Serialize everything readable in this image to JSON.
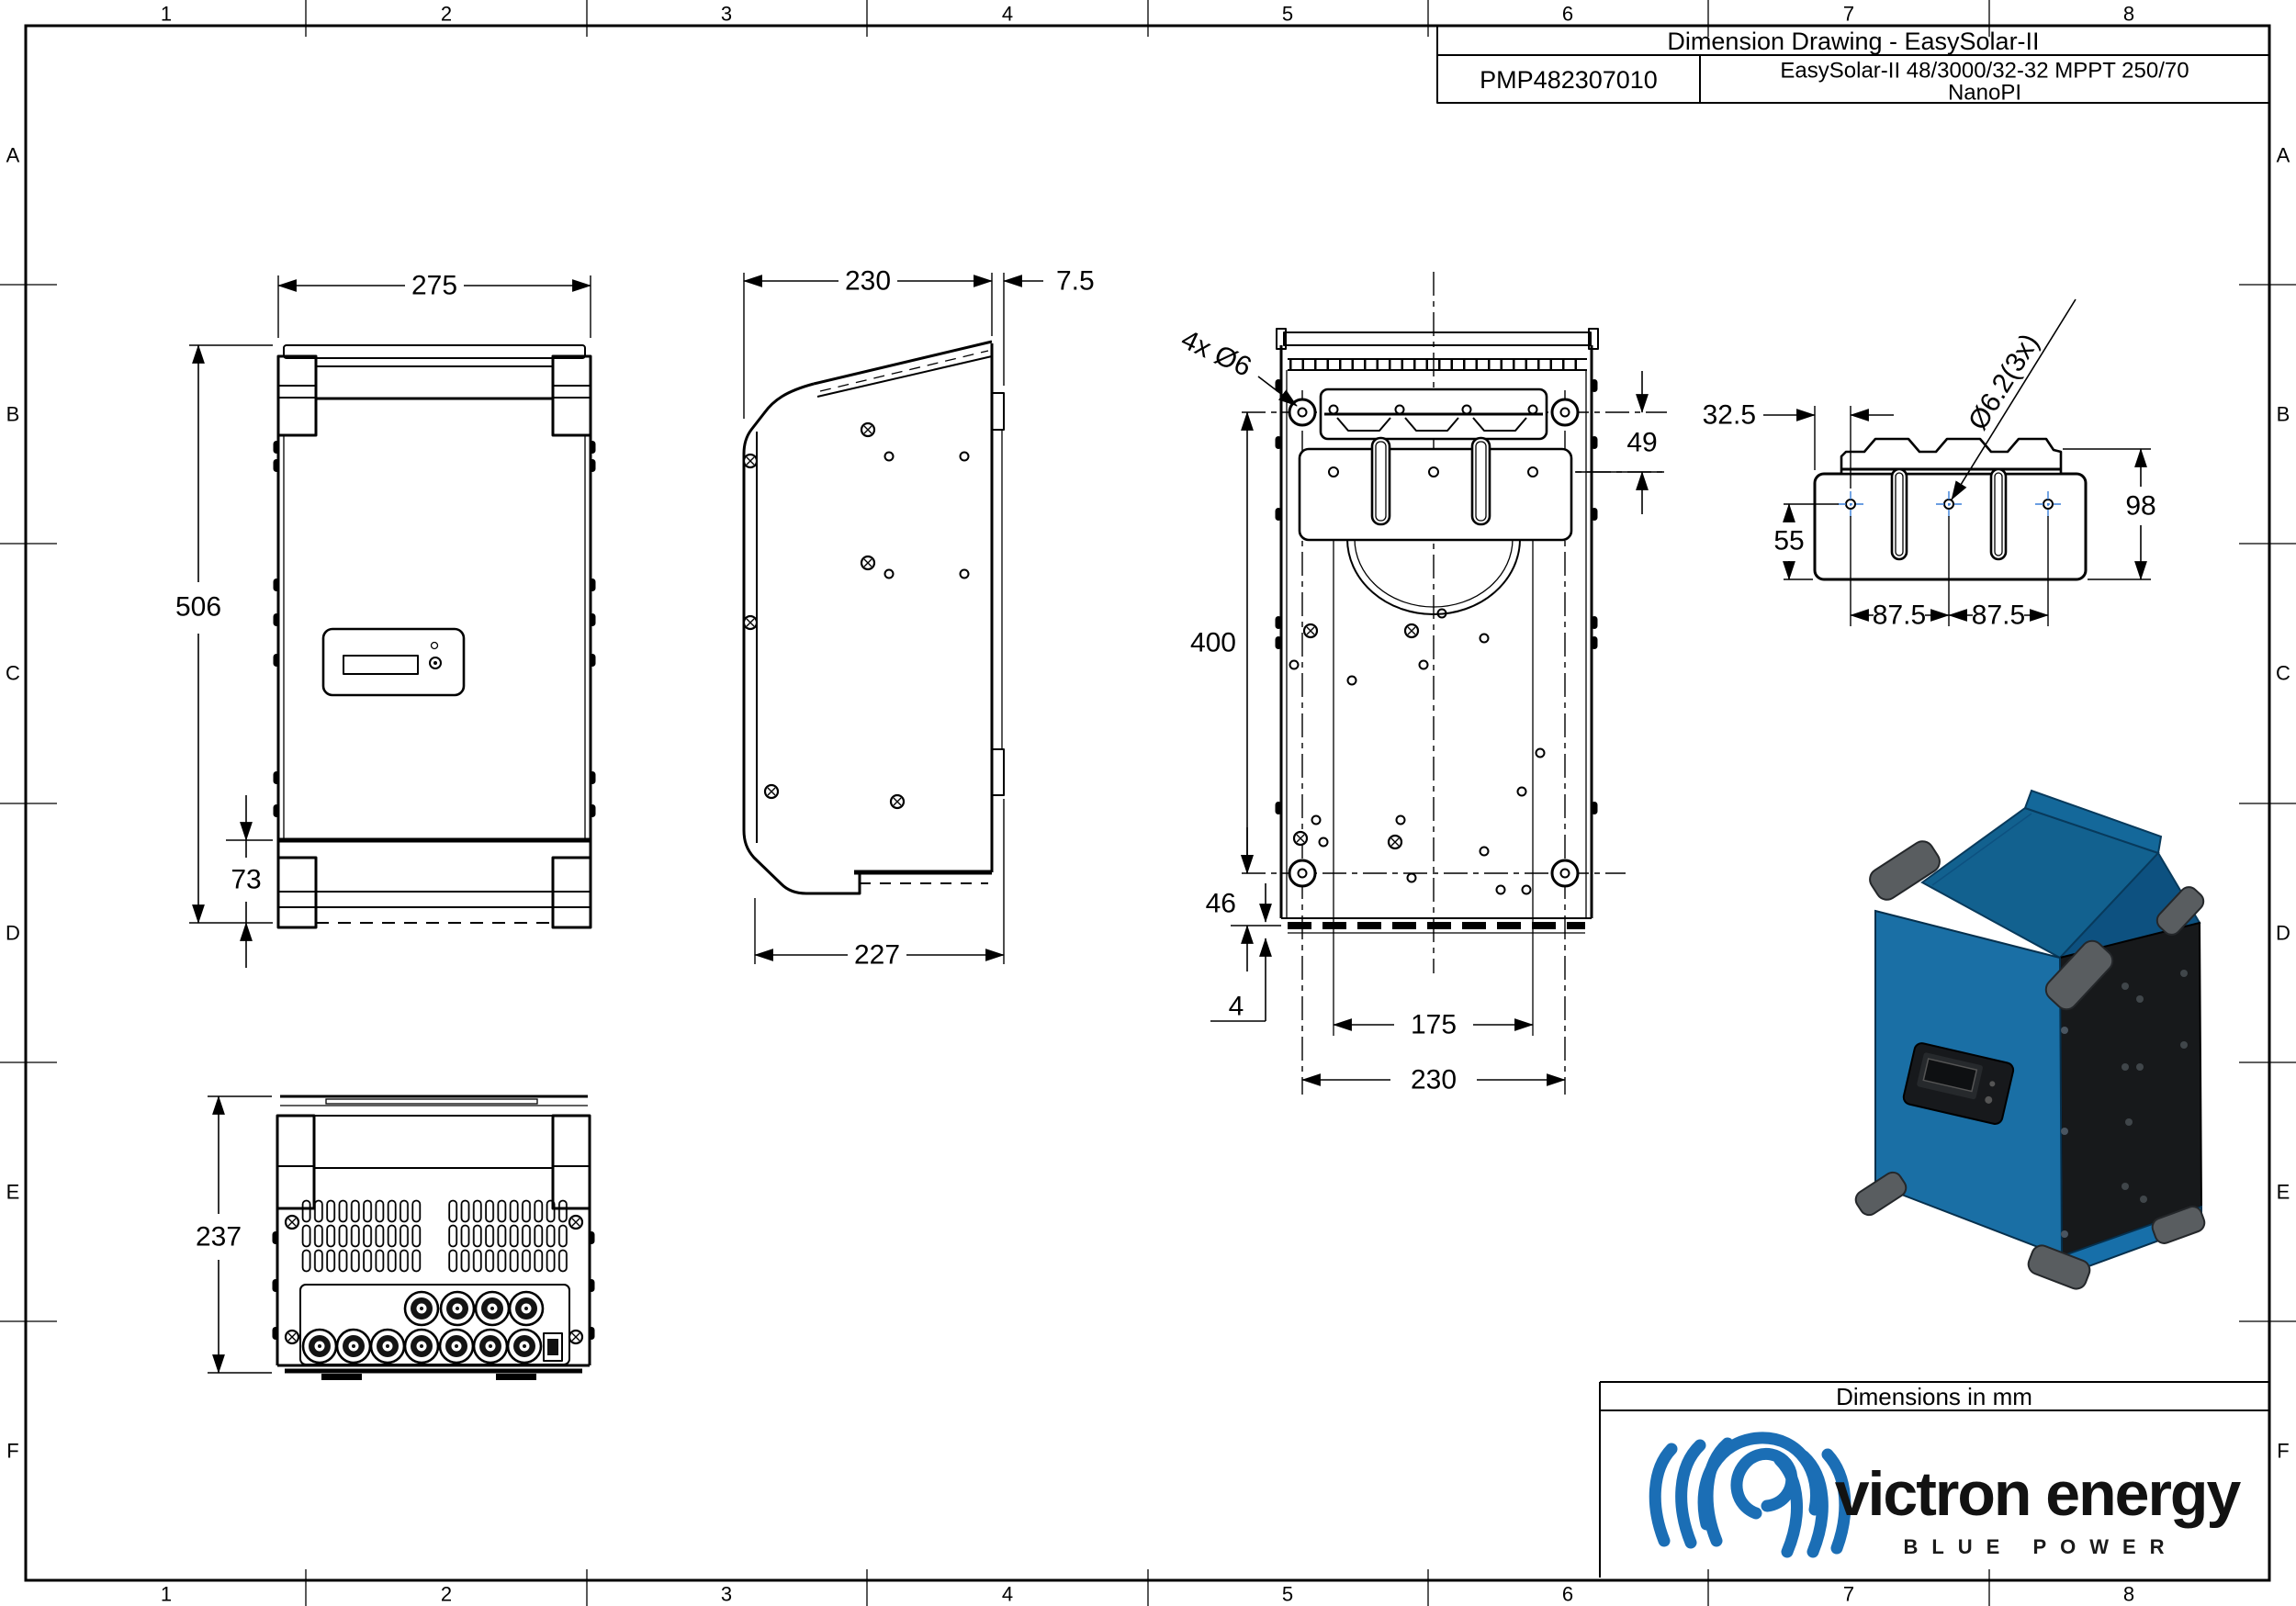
{
  "title_block": {
    "title": "Dimension Drawing - EasySolar-II",
    "part_number": "PMP482307010",
    "product_line1": "EasySolar-II 48/3000/32-32 MPPT 250/70",
    "product_line2": "NanoPI"
  },
  "frame": {
    "cols": [
      "1",
      "2",
      "3",
      "4",
      "5",
      "6",
      "7",
      "8"
    ],
    "rows": [
      "A",
      "B",
      "C",
      "D",
      "E",
      "F"
    ]
  },
  "dims": {
    "front_width": "275",
    "front_height": "506",
    "front_bottom_bracket": "73",
    "side_depth": "230",
    "side_wall_offset": "7.5",
    "side_bottom_depth": "227",
    "back_mount_holes": "4x Ø6",
    "back_top_offset": "49",
    "back_hole_vspacing": "400",
    "back_bottom_offset": "46",
    "back_foot": "4",
    "back_inner_spacing": "175",
    "back_hole_hspacing": "230",
    "bracket_edge_offset": "32.5",
    "bracket_drop": "55",
    "bracket_pitch_left": "87.5",
    "bracket_pitch_right": "87.5",
    "bracket_height": "98",
    "bracket_hole_dia": "Ø6.2(3x)",
    "bottom_depth": "237"
  },
  "footer": {
    "units_note": "Dimensions in mm",
    "brand": "victron energy",
    "tagline": "BLUE POWER"
  },
  "colors": {
    "line": "#000000",
    "centermark_blue": "#3a7fd8",
    "product_blue": "#1a6fa5",
    "product_dark_side": "#17191b",
    "logo_blue": "#1b6eb5"
  }
}
